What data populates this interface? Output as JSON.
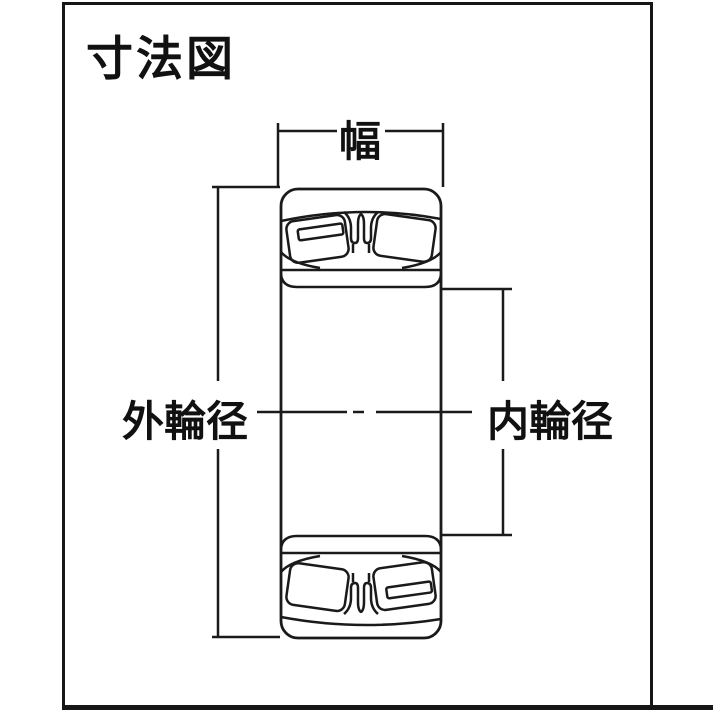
{
  "title": "寸法図",
  "diagram": {
    "type": "bearing-dimension-cross-section",
    "labels": {
      "width": "幅",
      "outer_ring_diameter": "外輪径",
      "inner_ring_diameter": "内輪径"
    },
    "colors": {
      "line": "#1a1a1a",
      "background": "#ffffff"
    }
  }
}
